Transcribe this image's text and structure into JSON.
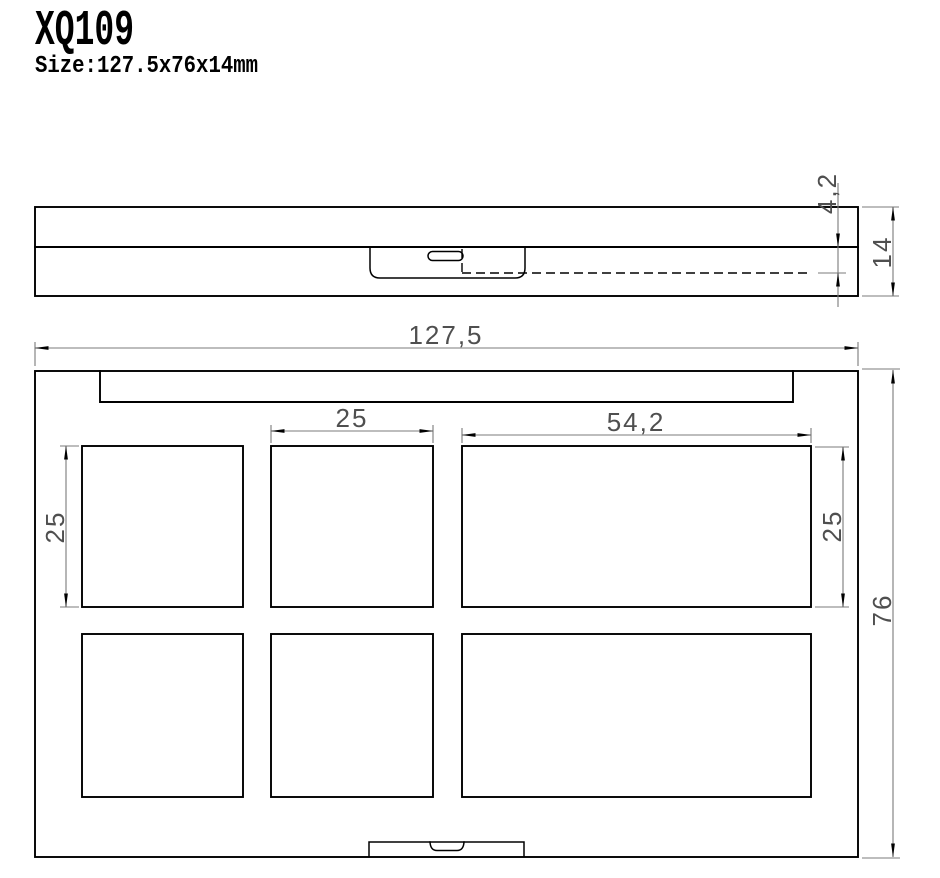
{
  "colors": {
    "object_line": "#000000",
    "dim_line": "#7b7b7b",
    "dim_text": "#4f4f4f"
  },
  "header": {
    "model": "XQ109",
    "size": "Size:127.5x76x14mm"
  },
  "side_view": {
    "dim_latch_depth": "4,2",
    "dim_total_height": "14"
  },
  "top_view": {
    "dim_total_width": "127,5",
    "dim_small_pan_width": "25",
    "dim_large_pan_width": "54,2",
    "dim_small_pan_height": "25",
    "dim_large_pan_height": "25",
    "dim_total_depth": "76"
  }
}
